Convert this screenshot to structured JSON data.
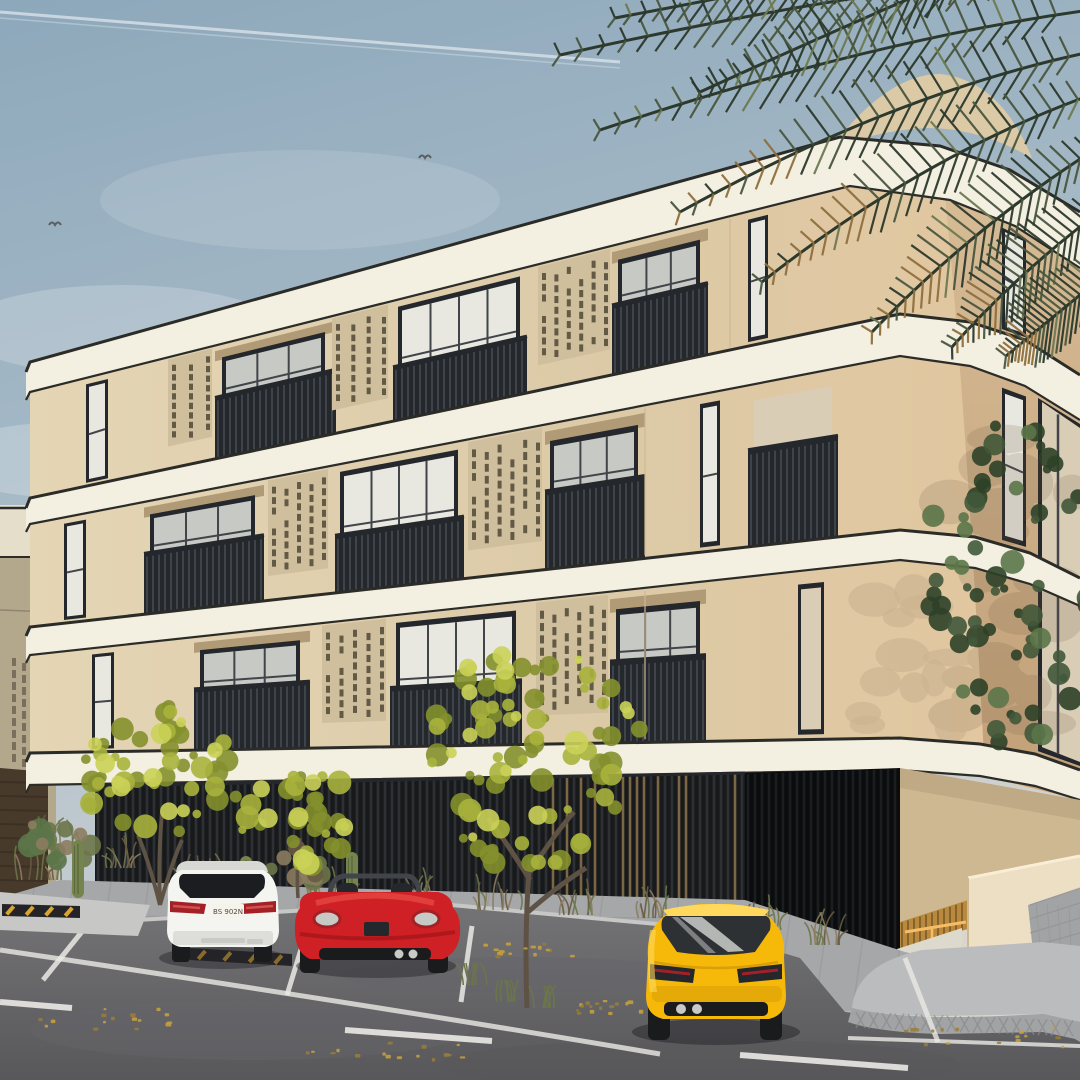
{
  "meta": {
    "title": "Architectural exterior rendering - corner view of a modern cream-stone apartment building",
    "description": "3D visualization of a three-storey beige residential building with rounded white floor bands, perforated masonry screen panels, dark gridded windows and slatted balcony railings. Palm fronds hang over the top-right corner, yellow-green trees and dry shrubs line the base, and a white SUV, red convertible and yellow sedan are parked on the gray asphalt street. A ramped garage entrance with a warm LED strip sits at the right."
  },
  "labels": {
    "license_plate": "BS 902N"
  },
  "palette": {
    "sky_top": "#8da8bb",
    "sky_mid": "#a7bac7",
    "sky_low": "#c3cbd0",
    "sky_warm": "#d8d6cd",
    "contrail": "#e9eff3",
    "cloud": "#dde4e7",
    "bird": "#5a5f63",
    "facade": "#dccaa7",
    "facade_light": "#e4d5b5",
    "facade_shade": "#cdb892",
    "right_glow": "#e3c69e",
    "right_face_top": "#d8bd97",
    "right_face_bot": "#c2a078",
    "band": "#f3efe1",
    "band_trim": "#2b2b28",
    "frame": "#24272b",
    "glass": "#e8e7e0",
    "glass_dark": "#c7c9c5",
    "glass_warm": "#dacdb6",
    "muntin": "#41454a",
    "perf_panel": "#cfbf9d",
    "perf_slot": "#564f3d",
    "railing": "#24282c",
    "railing_slat": "#4a5056",
    "soffit_shadow": "#b19b77",
    "screen_dark": "#17191b",
    "screen_slat": "#31363a",
    "screen_wood": "#86704b",
    "garage_dark": "#0b0c0d",
    "led": "#f6bd64",
    "led_glow": "#b98a3e",
    "interior_white": "#ded9cd",
    "ramp_wall": "#ecdfc3",
    "ramp_wall_lit": "#f8eed5",
    "platform": "#bbbcbe",
    "platform_side": "#a2a3a5",
    "platform_hatch": "#898a8c",
    "paver": "#a6a7a9",
    "paver_line": "#919294",
    "curb": "#c7c7c6",
    "street": "#747477",
    "street_dark": "#58585b",
    "street_patch": "#65656a",
    "marking": "#eceae5",
    "wheelstop": "#242428",
    "wheelstop_stripe": "#d9a62d",
    "neighbor_wall": "#b3a78c",
    "neighbor_band": "#e5decb",
    "neighbor_slot": "#6e6553",
    "neighbor_base": "#473a2b",
    "palm_dark": "#2c392c",
    "palm_mid": "#49573f",
    "palm_light": "#6d7a52",
    "palm_gold": "#8f6f3e",
    "tree_yellow": "#a9b33c",
    "tree_yellow_dark": "#84902c",
    "tree_yellow_light": "#cbd158",
    "tree_green": "#41583a",
    "tree_green_dark": "#2e4128",
    "tree_green_light": "#5b7549",
    "shrub": "#8b7c5f",
    "shrub_dark": "#675b43",
    "shrub_green": "#6c7549",
    "cactus": "#75834f",
    "trunk": "#5d5244",
    "tire": "#1a1b1d",
    "shadow": "#242427",
    "car_white": "#f4f4f1",
    "car_white_shade": "#d7d7d3",
    "suv_glass": "#1b1d20",
    "tail_red": "#a32126",
    "tail_red_bright": "#d35050",
    "plate": "#f6f4ea",
    "plate_text": "#4a4a48",
    "car_red": "#cf2025",
    "car_red_dark": "#8d1016",
    "car_red_light": "#ee5a4e",
    "car_yellow": "#f6b90a",
    "car_yellow_dark": "#c78d06",
    "car_yellow_light": "#ffd95e",
    "sedan_glass": "#2e3134",
    "sedan_glass_hi": "#cbcecb",
    "silver": "#c9c9c6",
    "leaf1": "#c9a23a",
    "leaf2": "#9a7c38",
    "wall_shadow": "#6e5a42"
  }
}
